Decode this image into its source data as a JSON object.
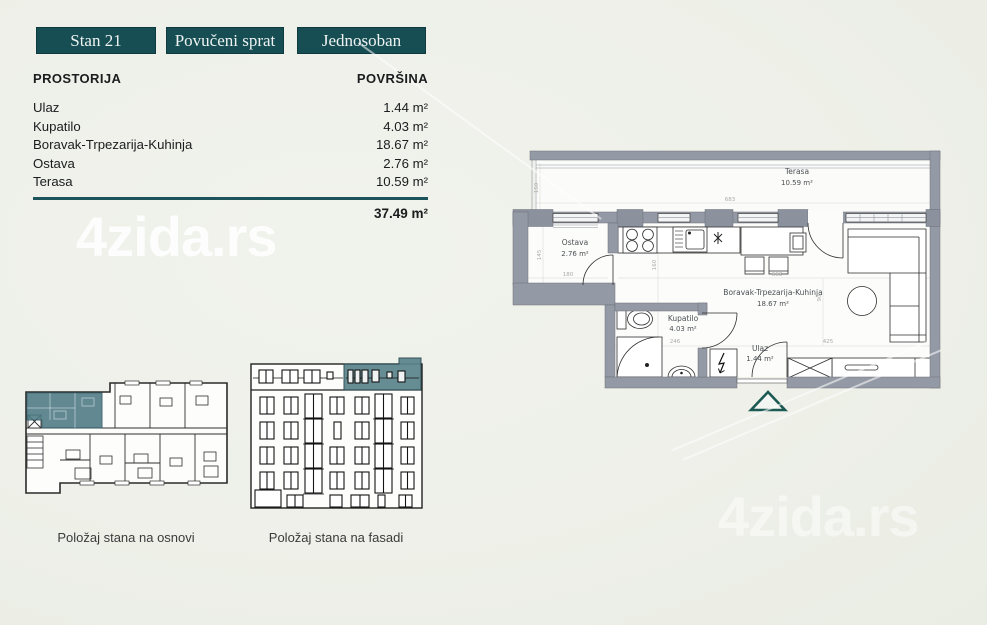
{
  "page": {
    "background": "#eff1ec",
    "accent_teal": "#174e54",
    "watermark_text": "4zida.rs"
  },
  "badges": [
    {
      "label": "Stan 21"
    },
    {
      "label": "Povučeni sprat"
    },
    {
      "label": "Jednosoban"
    }
  ],
  "area_table": {
    "header_room": "PROSTORIJA",
    "header_area": "POVRŠINA",
    "rows": [
      {
        "room": "Ulaz",
        "area": "1.44 m²"
      },
      {
        "room": "Kupatilo",
        "area": "4.03 m²"
      },
      {
        "room": "Boravak-Trpezarija-Kuhinja",
        "area": "18.67 m²"
      },
      {
        "room": "Ostava",
        "area": "2.76 m²"
      },
      {
        "room": "Terasa",
        "area": "10.59 m²"
      }
    ],
    "total_area": "37.49 m²"
  },
  "thumbnails": {
    "osnova_caption": "Položaj stana na osnovi",
    "fasada_caption": "Položaj stana na fasadi"
  },
  "floorplan": {
    "rooms": {
      "terasa": {
        "name": "Terasa",
        "area": "10.59 m²"
      },
      "ostava": {
        "name": "Ostava",
        "area": "2.76 m²"
      },
      "boravak": {
        "name": "Boravak-Trpezarija-Kuhinja",
        "area": "18.67 m²"
      },
      "kupatilo": {
        "name": "Kupatilo",
        "area": "4.03 m²"
      },
      "ulaz": {
        "name": "Ulaz",
        "area": "1.44 m²"
      }
    },
    "dims": {
      "terasa_w": "683",
      "terasa_d": "150",
      "ostava_d": "145",
      "ostava_w": "180",
      "living_w": "663",
      "kitchen_d": "160",
      "bath_w": "246",
      "hall_w": "425",
      "living_d": "90"
    }
  }
}
